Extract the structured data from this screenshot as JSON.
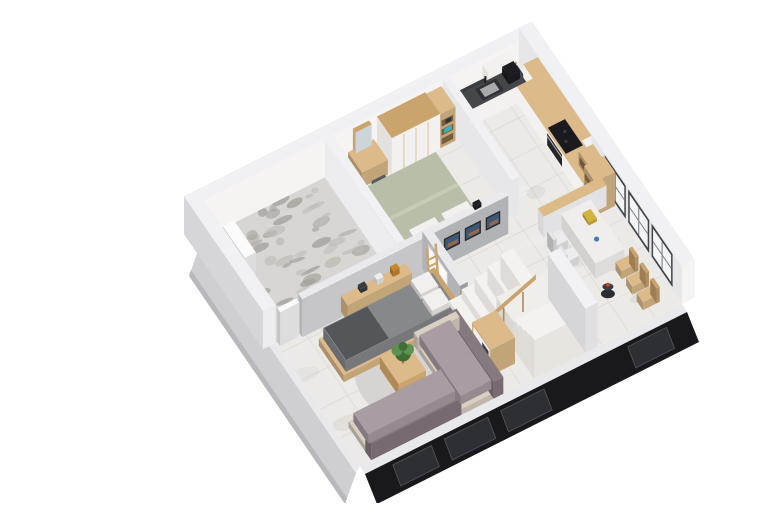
{
  "image": {
    "type": "3d-floor-plan-render",
    "description": "Isometric 3D render of an apartment floor plan with kitchen, dining nook, two bedrooms, terrace, central staircase and living room, cut-away black front facade",
    "background": "#ffffff"
  },
  "palette": {
    "bg": "#ffffff",
    "marble": "#eceae7",
    "marbleLine": "#d8d4d0",
    "marbleVein": "#c6c2bd",
    "marbleHi": "#f5f3f0",
    "terraceBase": "#d8d6d3",
    "terraceBlob1": "#a6a29c",
    "terraceBlob2": "#bfbbb5",
    "wallTop": "#f1f1f3",
    "wallWhite": "#f5f4f2",
    "wallLight": "#e7e7e9",
    "wallGray": "#b2b3b7",
    "wallGrayDark": "#9d9ea2",
    "wallOuter": "#d6d6d9",
    "bandGray": "#cfcfd3",
    "bandBlack": "#19191d",
    "bandWindow": "#2e2f34",
    "bandFrame": "#54555b",
    "bandStrip": "#e9e9eb",
    "winFrame": "#43444a",
    "winGlass": "#f3f5f6",
    "winMullion": "#8b8c92",
    "woodLight": "#dcba8a",
    "woodMid": "#caa36d",
    "woodDark": "#b08a55",
    "woodInset": "#6e5636",
    "cabWhite": "#f2f1ef",
    "cabSide": "#e3e1de",
    "counterDark": "#45464a",
    "splash": "#3b3c40",
    "steel": "#a8aaae",
    "black": "#1e1e22",
    "sage": "#b8bea7",
    "sageHi": "#c6cbb6",
    "duvet": "#87888c",
    "duvetDark": "#55565a",
    "pillow": "#f1f0ee",
    "sofaSeat": "#a89da3",
    "sofaBack": "#857a80",
    "sofaBase": "#d9d0c4",
    "rug": "#d5d3d2",
    "plant1": "#3f6f36",
    "plant2": "#5d9150",
    "teal": "#35b4ba",
    "amber": "#c8872f",
    "red": "#c2472e",
    "mirror": "#ccd5d9",
    "frameDark": "#2c2925",
    "artBlue": "#3c5a78",
    "artOrange": "#b06a3a",
    "door": "#fbfbfc",
    "doorEdge": "#cfcfd2",
    "tread": "#f4f2ef",
    "riser": "#dfdcd7",
    "landing": "#f0eeeb",
    "yellow": "#d4b23c",
    "blue": "#4a7ab5"
  },
  "rooms": [
    {
      "id": "kitchen",
      "label": "Kitchen",
      "furniture": [
        "l-shaped-counter",
        "sink",
        "coffee-machine",
        "cooktop",
        "oven",
        "wall-cabinet",
        "upper-cabinets",
        "open-wood-shelves"
      ]
    },
    {
      "id": "dining",
      "label": "Dining nook",
      "furniture": [
        "peninsula-half-wall",
        "breakfast-table",
        "white-chairs",
        "wood-chairs",
        "accent-stool",
        "window-wall"
      ]
    },
    {
      "id": "bedroom-1",
      "label": "Bedroom 1",
      "furniture": [
        "display-shelf",
        "wardrobe",
        "dressing-table",
        "mirror",
        "stool",
        "double-bed-sage"
      ]
    },
    {
      "id": "terrace",
      "label": "Terrace",
      "furniture": [
        "patterned-floor",
        "door-panel"
      ]
    },
    {
      "id": "bedroom-2",
      "label": "Bedroom 2",
      "furniture": [
        "console-table",
        "runner-rug",
        "double-bed-gray",
        "ladder-shelf"
      ]
    },
    {
      "id": "hall",
      "label": "Hallway",
      "furniture": [
        "picture-frames",
        "wall-camera",
        "white-door"
      ]
    },
    {
      "id": "stairs",
      "label": "Staircase",
      "furniture": [
        "lower-flight",
        "landing",
        "upper-flight",
        "wood-railing",
        "white-balustrade"
      ]
    },
    {
      "id": "living",
      "label": "Living room",
      "furniture": [
        "corner-sofa",
        "round-rug",
        "coffee-table",
        "plant",
        "shelf-unit"
      ]
    }
  ],
  "exterior": {
    "front_facade": "black-cutaway-band-with-windows",
    "side_facade": "light-gray-cutaway-band",
    "back_walls": "white-full-height",
    "right_wall": "three-large-windows-dark-frames"
  }
}
